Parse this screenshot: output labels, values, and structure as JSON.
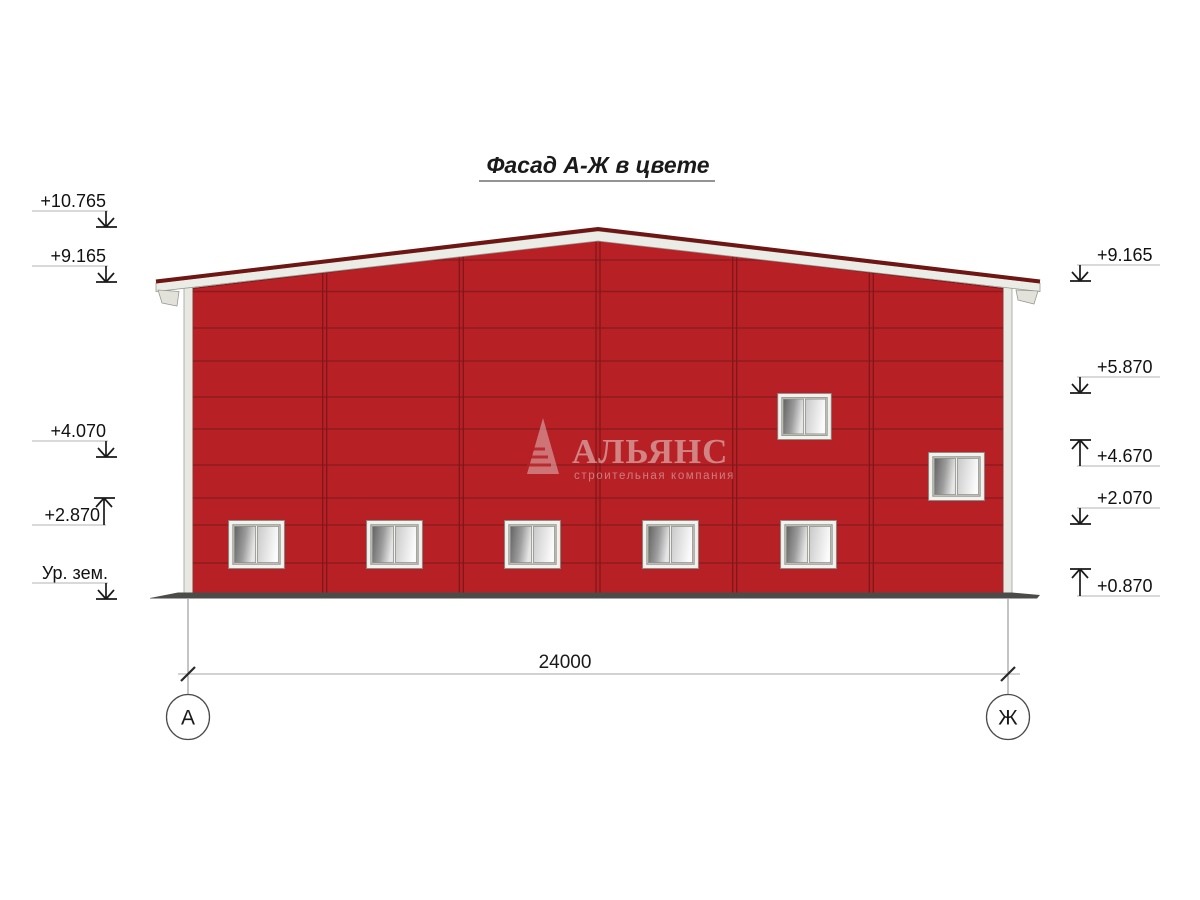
{
  "title": {
    "text": "Фасад А-Ж в цвете"
  },
  "marks_left": [
    {
      "value": "+10.765",
      "arrow": "down"
    },
    {
      "value": "+9.165",
      "arrow": "down"
    },
    {
      "value": "+4.070",
      "arrow": "down"
    },
    {
      "value": "+2.870",
      "arrow": "up"
    },
    {
      "value": "Ур. зем.",
      "arrow": "down"
    }
  ],
  "marks_right": [
    {
      "value": "+9.165",
      "arrow": "down"
    },
    {
      "value": "+5.870",
      "arrow": "down"
    },
    {
      "value": "+4.670",
      "arrow": "up"
    },
    {
      "value": "+2.070",
      "arrow": "down"
    },
    {
      "value": "+0.870",
      "arrow": "up"
    }
  ],
  "dimension": {
    "total": "24000"
  },
  "axis_bubbles": {
    "left": "А",
    "right": "Ж"
  },
  "watermark": {
    "brand": "АЛЬЯНС",
    "tagline": "строительная компания"
  },
  "facade": {
    "bottom_row_window_count": 5,
    "upper_window_count": 2,
    "bay_count": 6
  },
  "colors": {
    "facade_red": "#b72025",
    "panel_joint": "#8f1a1e",
    "roof_cap": "#6d1613",
    "fascia_white": "#ecece6",
    "corner_trim": "#e8e8e2",
    "ground": "#4b4b49"
  }
}
